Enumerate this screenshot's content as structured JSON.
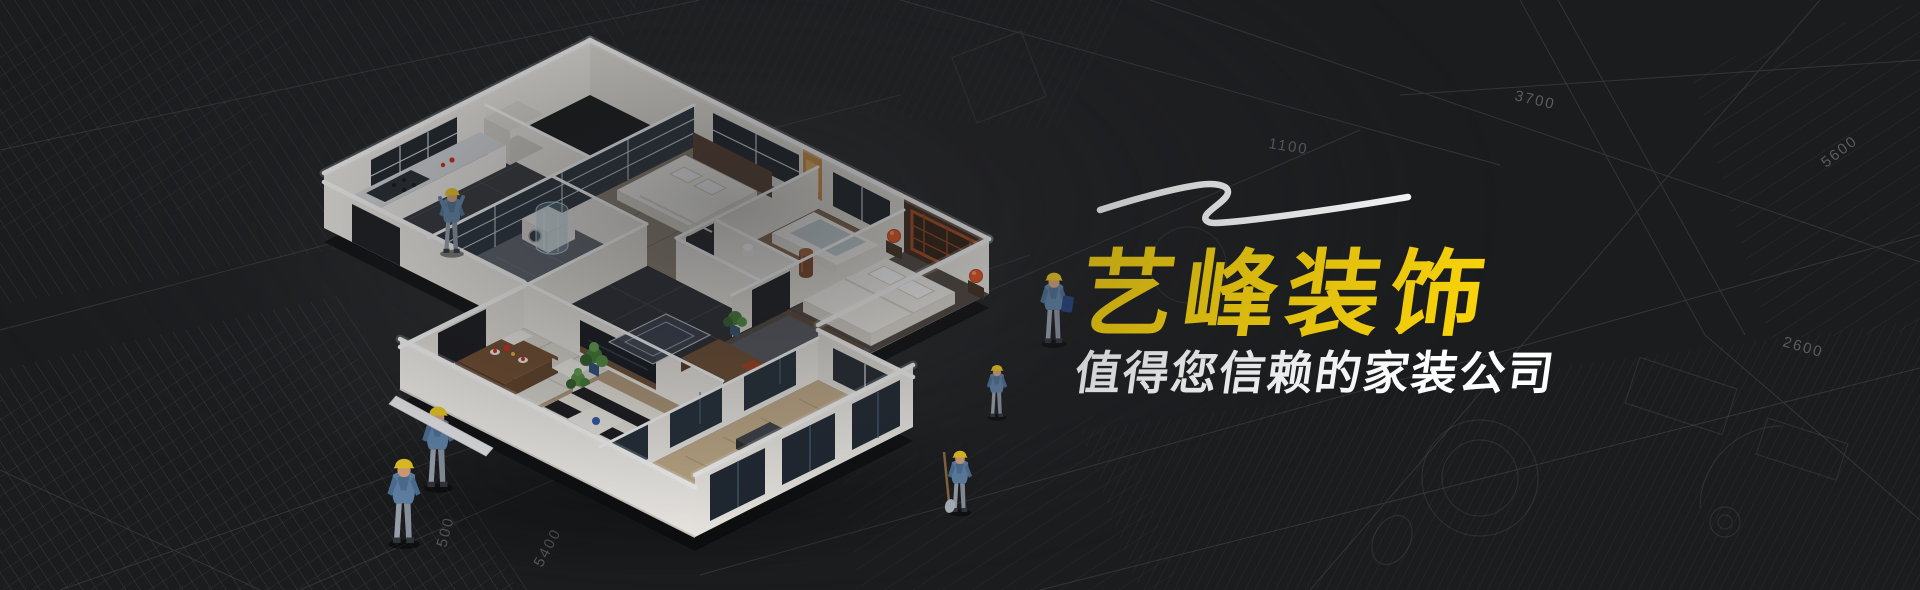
{
  "hero": {
    "title": "艺峰装饰",
    "subtitle": "值得您信赖的家装公司"
  },
  "colors": {
    "background": "#1b1c1e",
    "blueprint_lines": "#4b4d51",
    "title_yellow": "#f9d30a",
    "tagline_white": "#ffffff",
    "hardhat_yellow": "#edc91f",
    "lantern_orange": "#e8521c",
    "building_white": "#f4f1eb"
  },
  "blueprint": {
    "dimension_labels": [
      "3700",
      "5600",
      "2600",
      "1100",
      "5400",
      "500"
    ]
  }
}
